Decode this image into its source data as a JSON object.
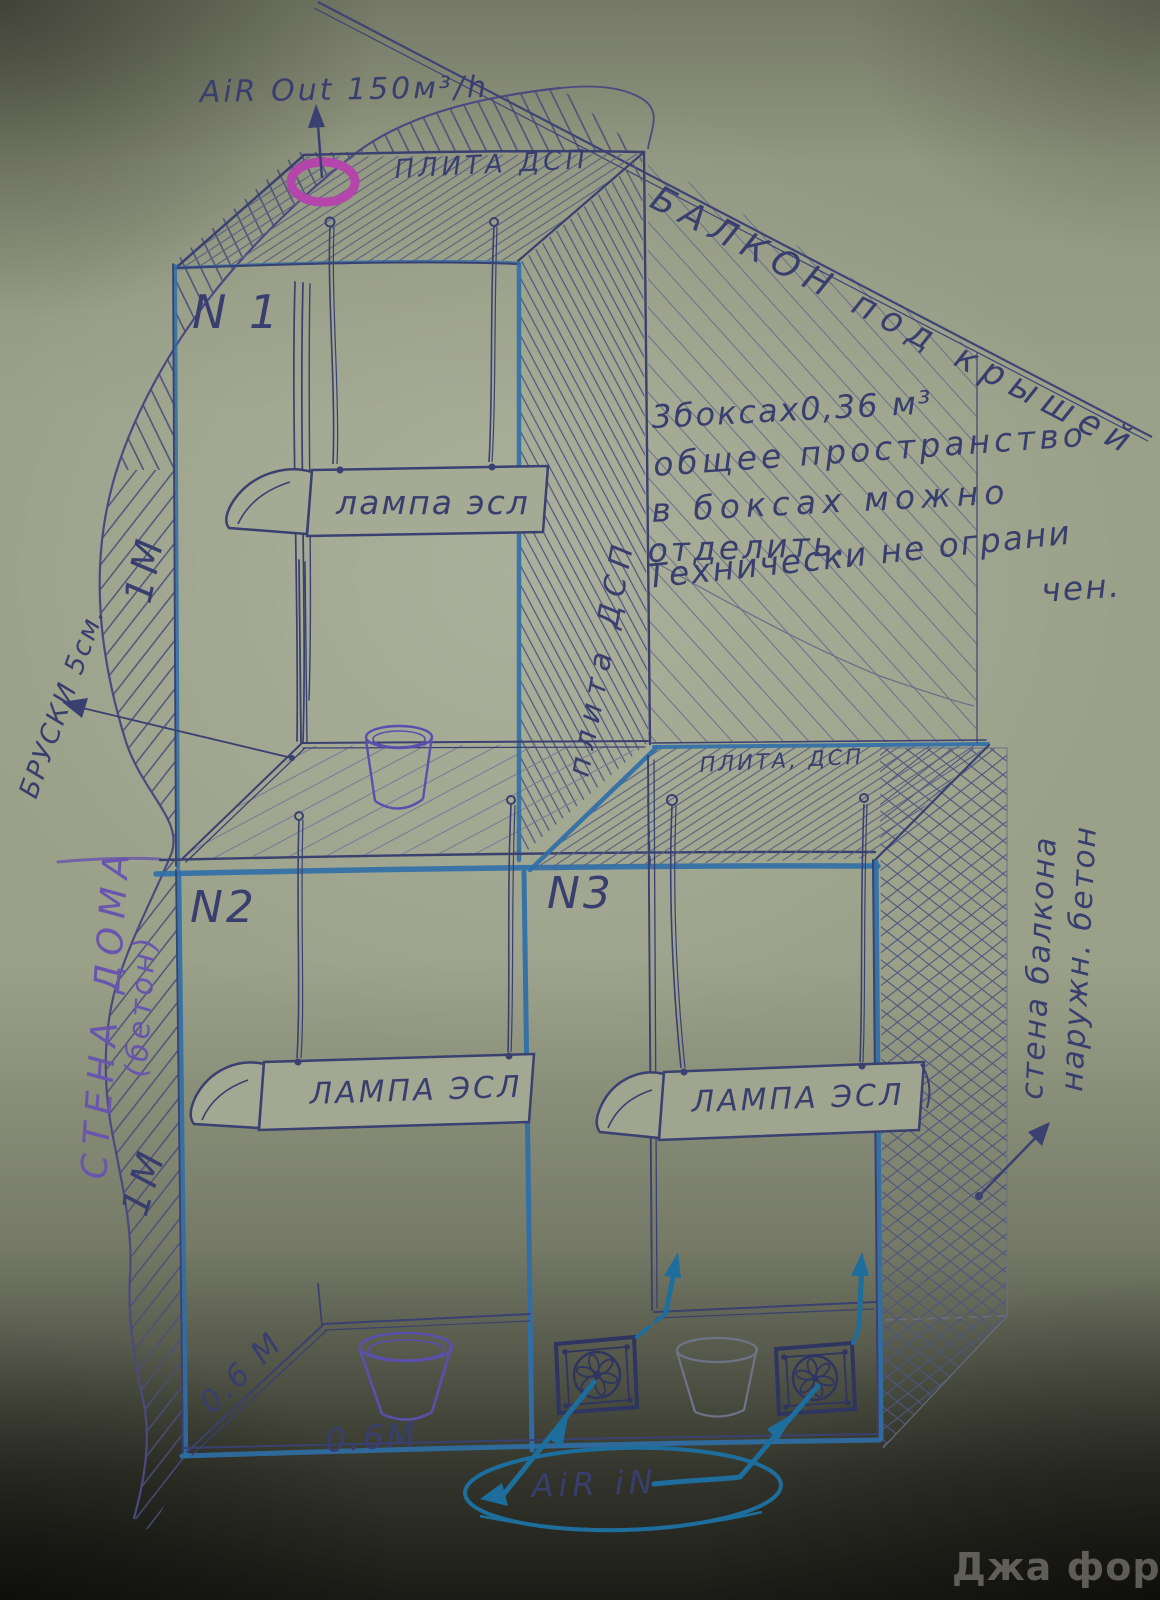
{
  "airflow": {
    "air_out": "AiR Out 150м³/h",
    "air_in": "AiR iN"
  },
  "environment": {
    "balcony_roof": "БАЛКОН под крышей",
    "house_wall_line1": "СТЕНА ДОМА",
    "house_wall_line2": "(бетон)",
    "battens": "БРУСКИ 5см.",
    "balcony_wall_line1": "стена балкона",
    "balcony_wall_line2": "наружн. бетон"
  },
  "plates": {
    "top": "ПЛИТА ДСП",
    "side": "плита ДСП",
    "n3_top": "ПЛИТА, ДСП"
  },
  "note": {
    "line1": "3боксах0,36 м³",
    "line2": "общее пространство",
    "line3": "в боксах можно",
    "line4": "отделить.",
    "line5": "Технически не ограни",
    "line6": "чен."
  },
  "boxes": {
    "n1": {
      "label": "N 1",
      "lamp": "лампа эсл"
    },
    "n2": {
      "label": "N2",
      "lamp": "ЛАМПА ЭСЛ"
    },
    "n3": {
      "label": "N3",
      "lamp": "ЛАМПА ЭСЛ"
    }
  },
  "dimensions": {
    "height_upper": "1М",
    "height_lower": "1М",
    "depth": "0.6 М",
    "width": "0.6М"
  },
  "watermark": "Джа форум",
  "colors": {
    "paper": "#9ba189",
    "ink_navy": "#3a4070",
    "marker_blue": "#2f6fa8",
    "purple": "#6a55ae",
    "magenta": "#b445ab",
    "teal": "#1d6e9c",
    "pencil": "#6b7288"
  }
}
